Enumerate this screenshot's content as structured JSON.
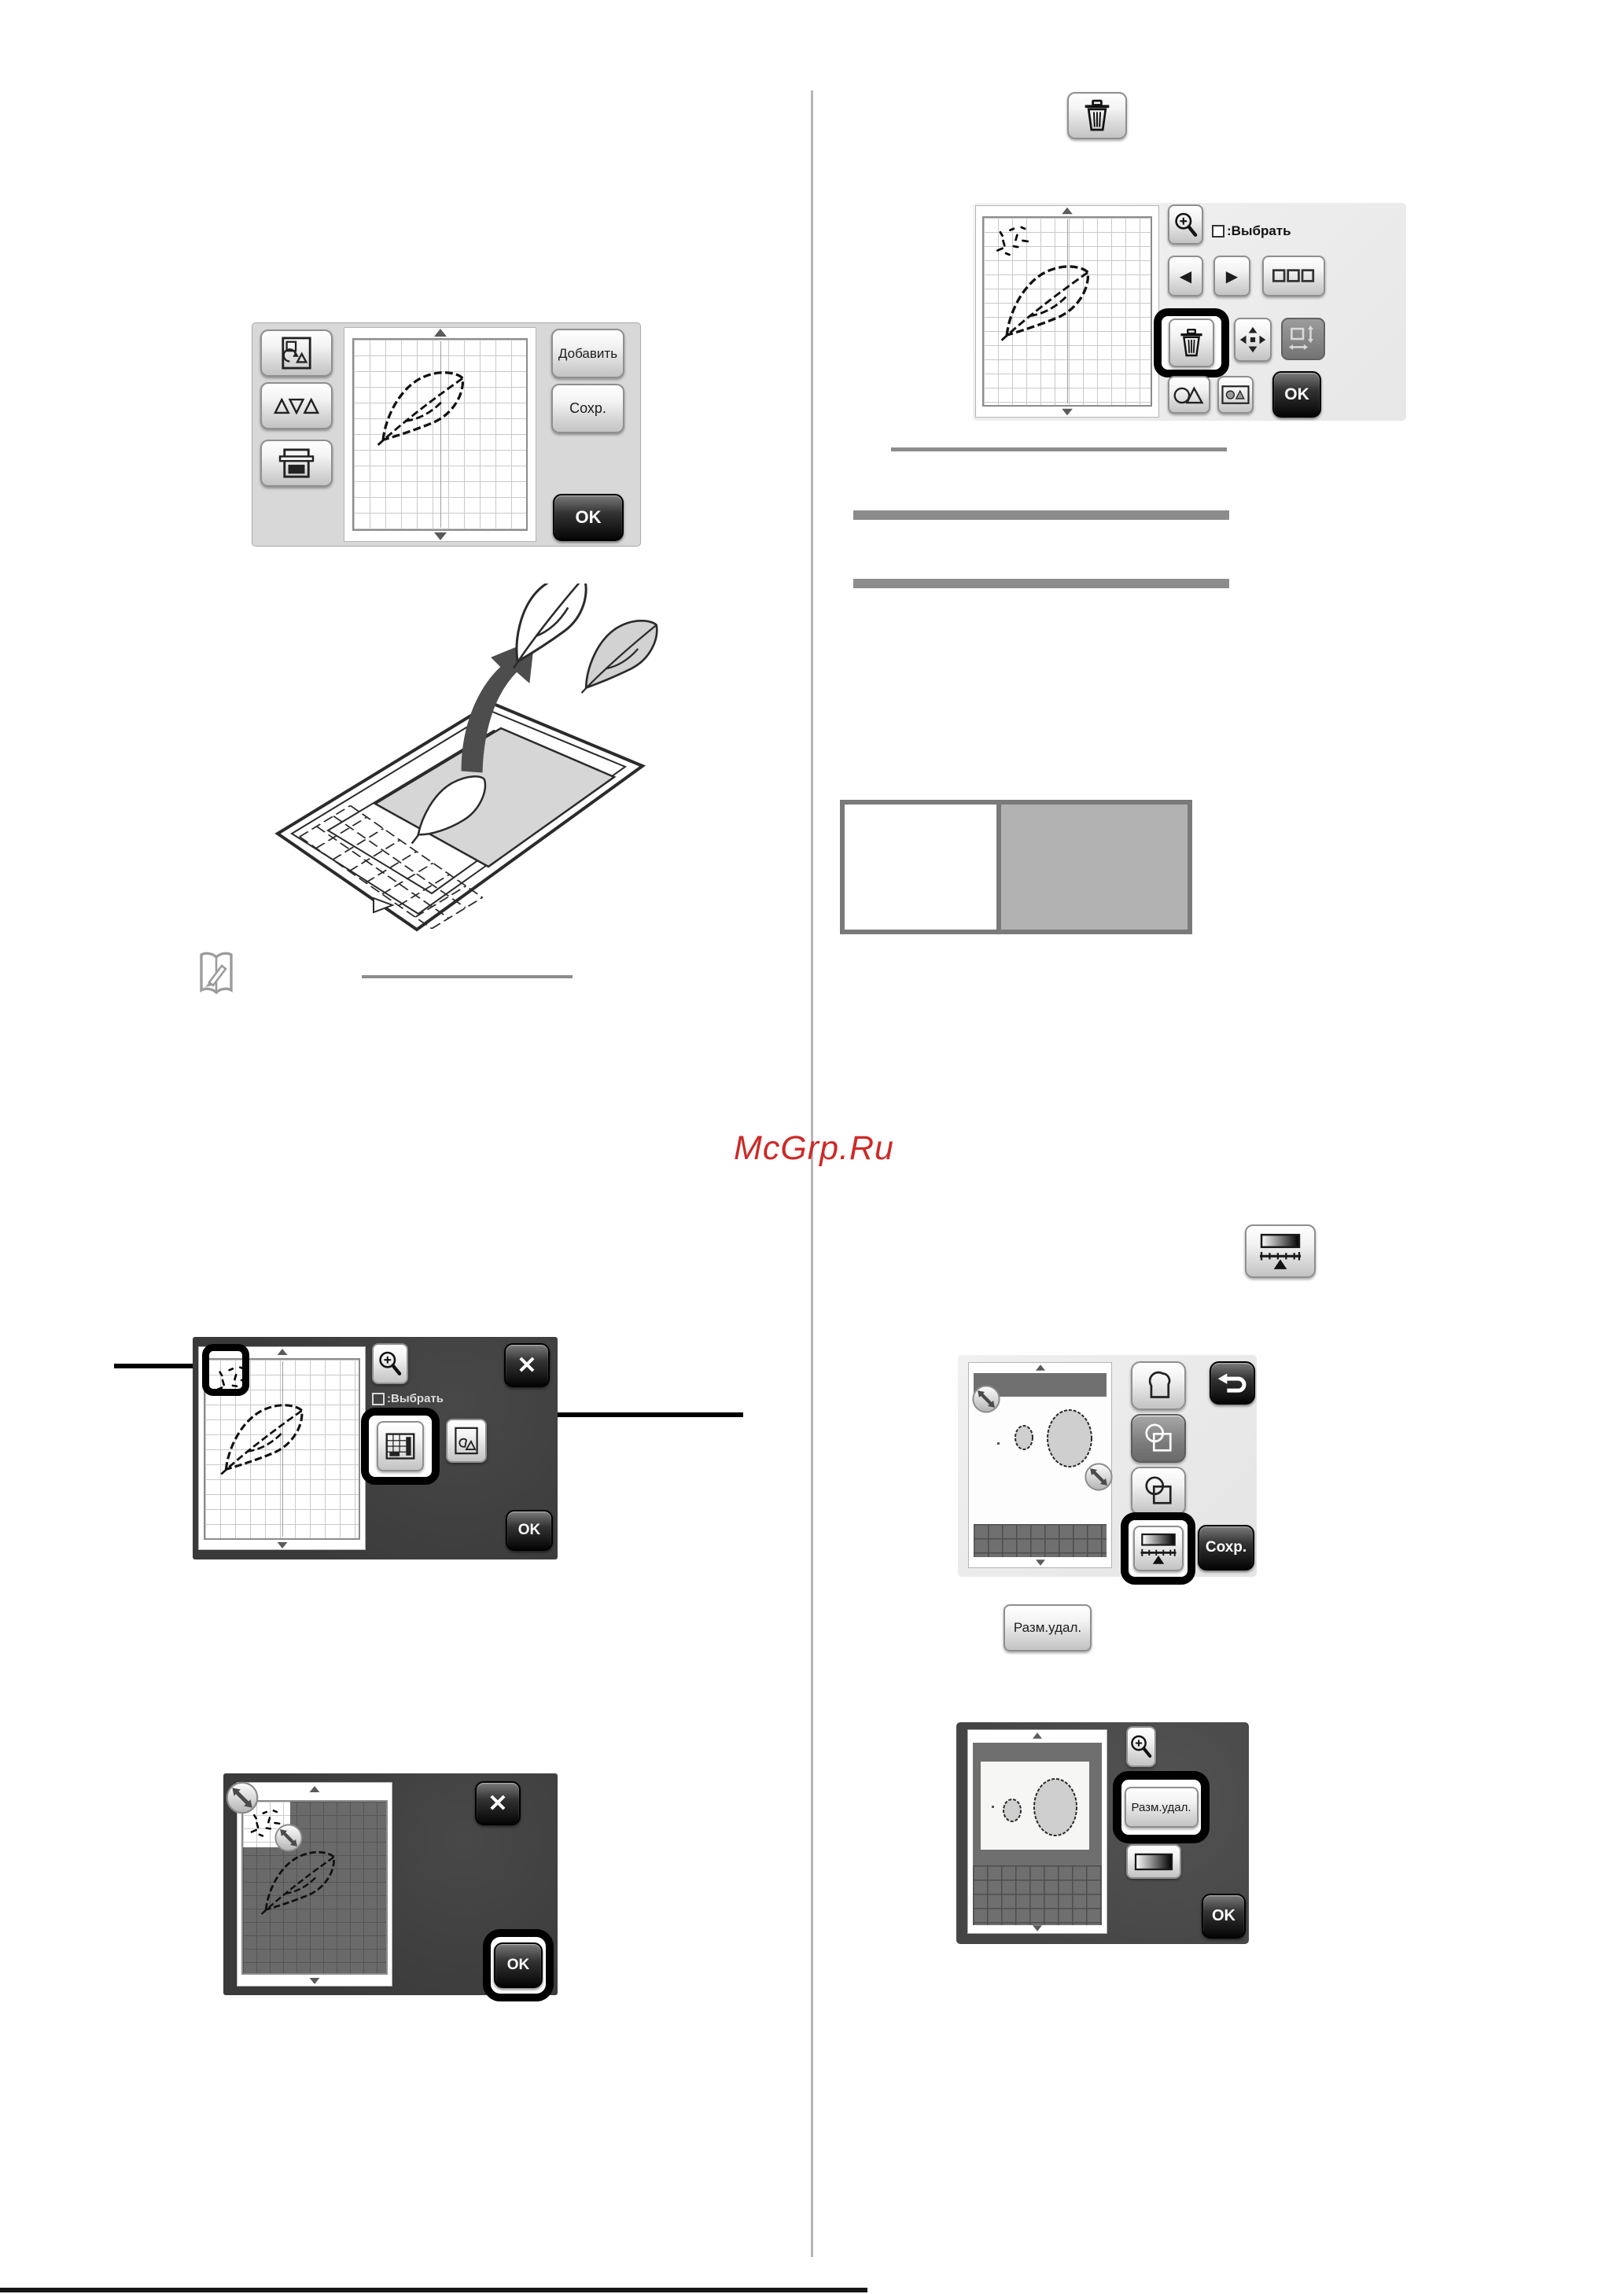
{
  "watermark": {
    "text": "McGrp.Ru",
    "color": "#cc2a28"
  },
  "icons": {
    "close_glyph": "✕",
    "prev_glyph": "◀",
    "next_glyph": "▶"
  },
  "edit_screen": {
    "add_label": "Добавить",
    "save_label": "Сохр.",
    "ok_label": "OK"
  },
  "scan_edit_screen": {
    "select_hint": ":Выбрать",
    "ok_label": "OK"
  },
  "region_screen": {
    "select_hint": ":Выбрать",
    "ok_label": "OK"
  },
  "crop_screen": {
    "ok_label": "OK"
  },
  "trace_screen": {
    "save_label": "Сохр."
  },
  "size_delete_button_label": "Разм.удал.",
  "size_delete_screen": {
    "size_delete_label": "Разм.удал.",
    "ok_label": "OK"
  }
}
